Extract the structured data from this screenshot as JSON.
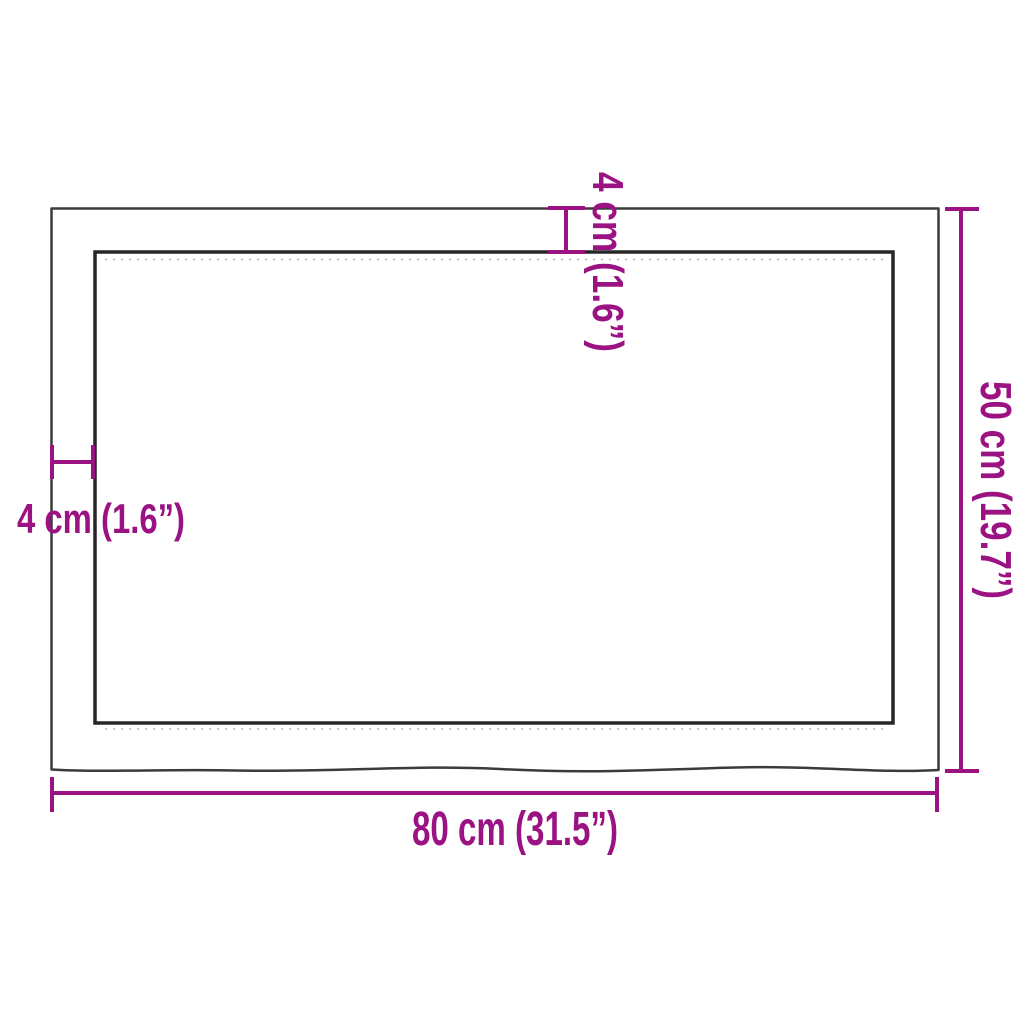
{
  "diagram": {
    "title": "tabletop panel dimension drawing",
    "colors": {
      "dimension_accent": "#9B1283",
      "panel_outline": "#3b3b3b",
      "background": "#ffffff"
    },
    "dimensions": {
      "width_bottom": {
        "label": "80 cm (31.5”)",
        "position": "bottom"
      },
      "height_right": {
        "label": "50 cm (19.7”)",
        "position": "right"
      },
      "edge_top": {
        "label": "4 cm (1.6”)",
        "position": "top"
      },
      "edge_left": {
        "label": "4 cm (1.6”)",
        "position": "left"
      }
    }
  }
}
